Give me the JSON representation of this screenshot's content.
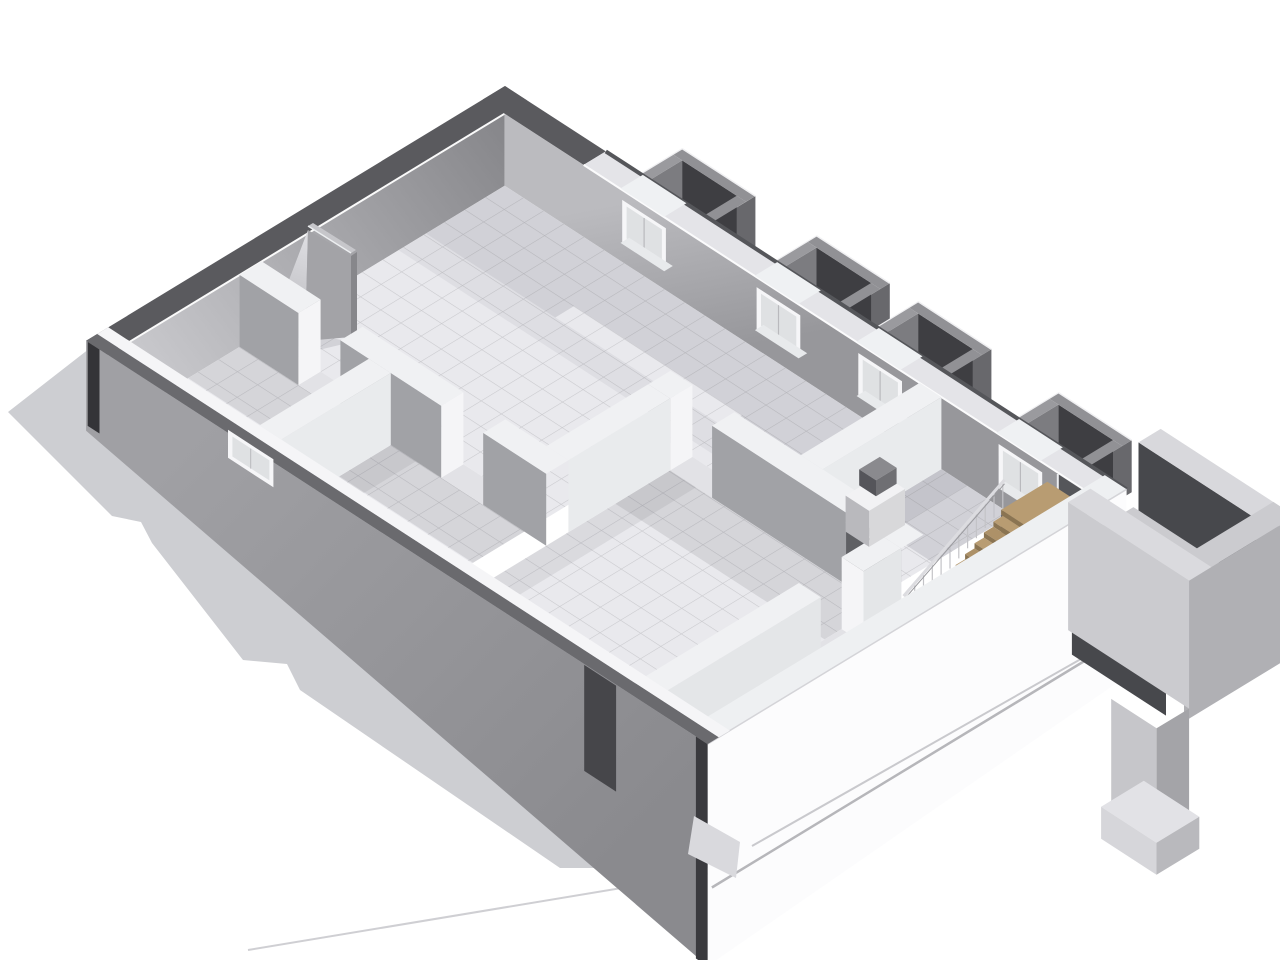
{
  "meta": {
    "title": "Isometric 3D cutaway floor plan render",
    "view": "axonometric cutaway, basement level",
    "background": "#ffffff"
  },
  "palette": {
    "bg": "#ffffff",
    "shadow": "#cdced2",
    "shadowInner": "#bdbdc1",
    "capDark": "#5a5a5e",
    "capLight": "#e4e4e8",
    "cutWhite": "#f5f5f7",
    "wallBackRight": "#a7a7ab",
    "wallExtLeft": "#95959a",
    "extWhite": "#fcfcfd",
    "slabLine": "#b6b6ba",
    "partitionLit": "#e9ebed",
    "partitionShade": "#a1a2a6",
    "partitionCap": "#f0f1f3",
    "floor": "#e9e9ed",
    "tileLine": "#c8c8cc",
    "floorShade": "#5a5a64",
    "wellDark": "#3e3e42",
    "wellMid": "#7c7c80",
    "wellOuter": "#68686c",
    "wellRim": "#919195",
    "wellFloor": "#a6a6aa",
    "windowWhite": "#f6f6f8",
    "glass": "#dfe1e3",
    "doorDark": "#5f6064",
    "woodTop": "#b89c72",
    "woodAlt": "#ad9168",
    "woodRiser": "#8a7452",
    "railLight": "#dcdce0",
    "railPost": "#c3c3c7",
    "courtLight": "#cbcbcf",
    "courtMid": "#b0b0b4",
    "courtDark": "#47484c",
    "courtCap": "#d8d8dc",
    "chimFront": "#a3a3a7",
    "chimSide": "#87878b",
    "chimSlope": "#d0d0d4",
    "chimTop": "#c6c6ca"
  },
  "scene": {
    "building": {
      "type": "residential floor cutaway",
      "exterior_walls": 4,
      "ground_shadow": true,
      "floor_finish": "tile grid"
    },
    "rooms": [
      {
        "name": "large-tiled-room",
        "shape": "L",
        "position": "upper-left"
      },
      {
        "name": "utility-room",
        "position": "top-center-right"
      },
      {
        "name": "middle-room",
        "position": "center-bottom"
      },
      {
        "name": "small-room-left",
        "position": "lower-left"
      },
      {
        "name": "small-room-center",
        "position": "lower-center"
      },
      {
        "name": "stair-hall",
        "position": "right"
      }
    ],
    "features": {
      "window_wells": {
        "count": 4,
        "description": "dark concrete light wells along upper-right exterior wall"
      },
      "windows": {
        "count": 5
      },
      "staircase": {
        "steps": 10,
        "landing": true,
        "material": "wood",
        "railing": true
      },
      "doors": {
        "panels": 3,
        "open_doorways": 4
      },
      "chimney_wedge": {
        "present": true,
        "position": "large room near back-left wall"
      },
      "entry_structure": {
        "description": "exterior concrete entry walkway with parapet walls and support pier",
        "position": "right"
      }
    }
  }
}
